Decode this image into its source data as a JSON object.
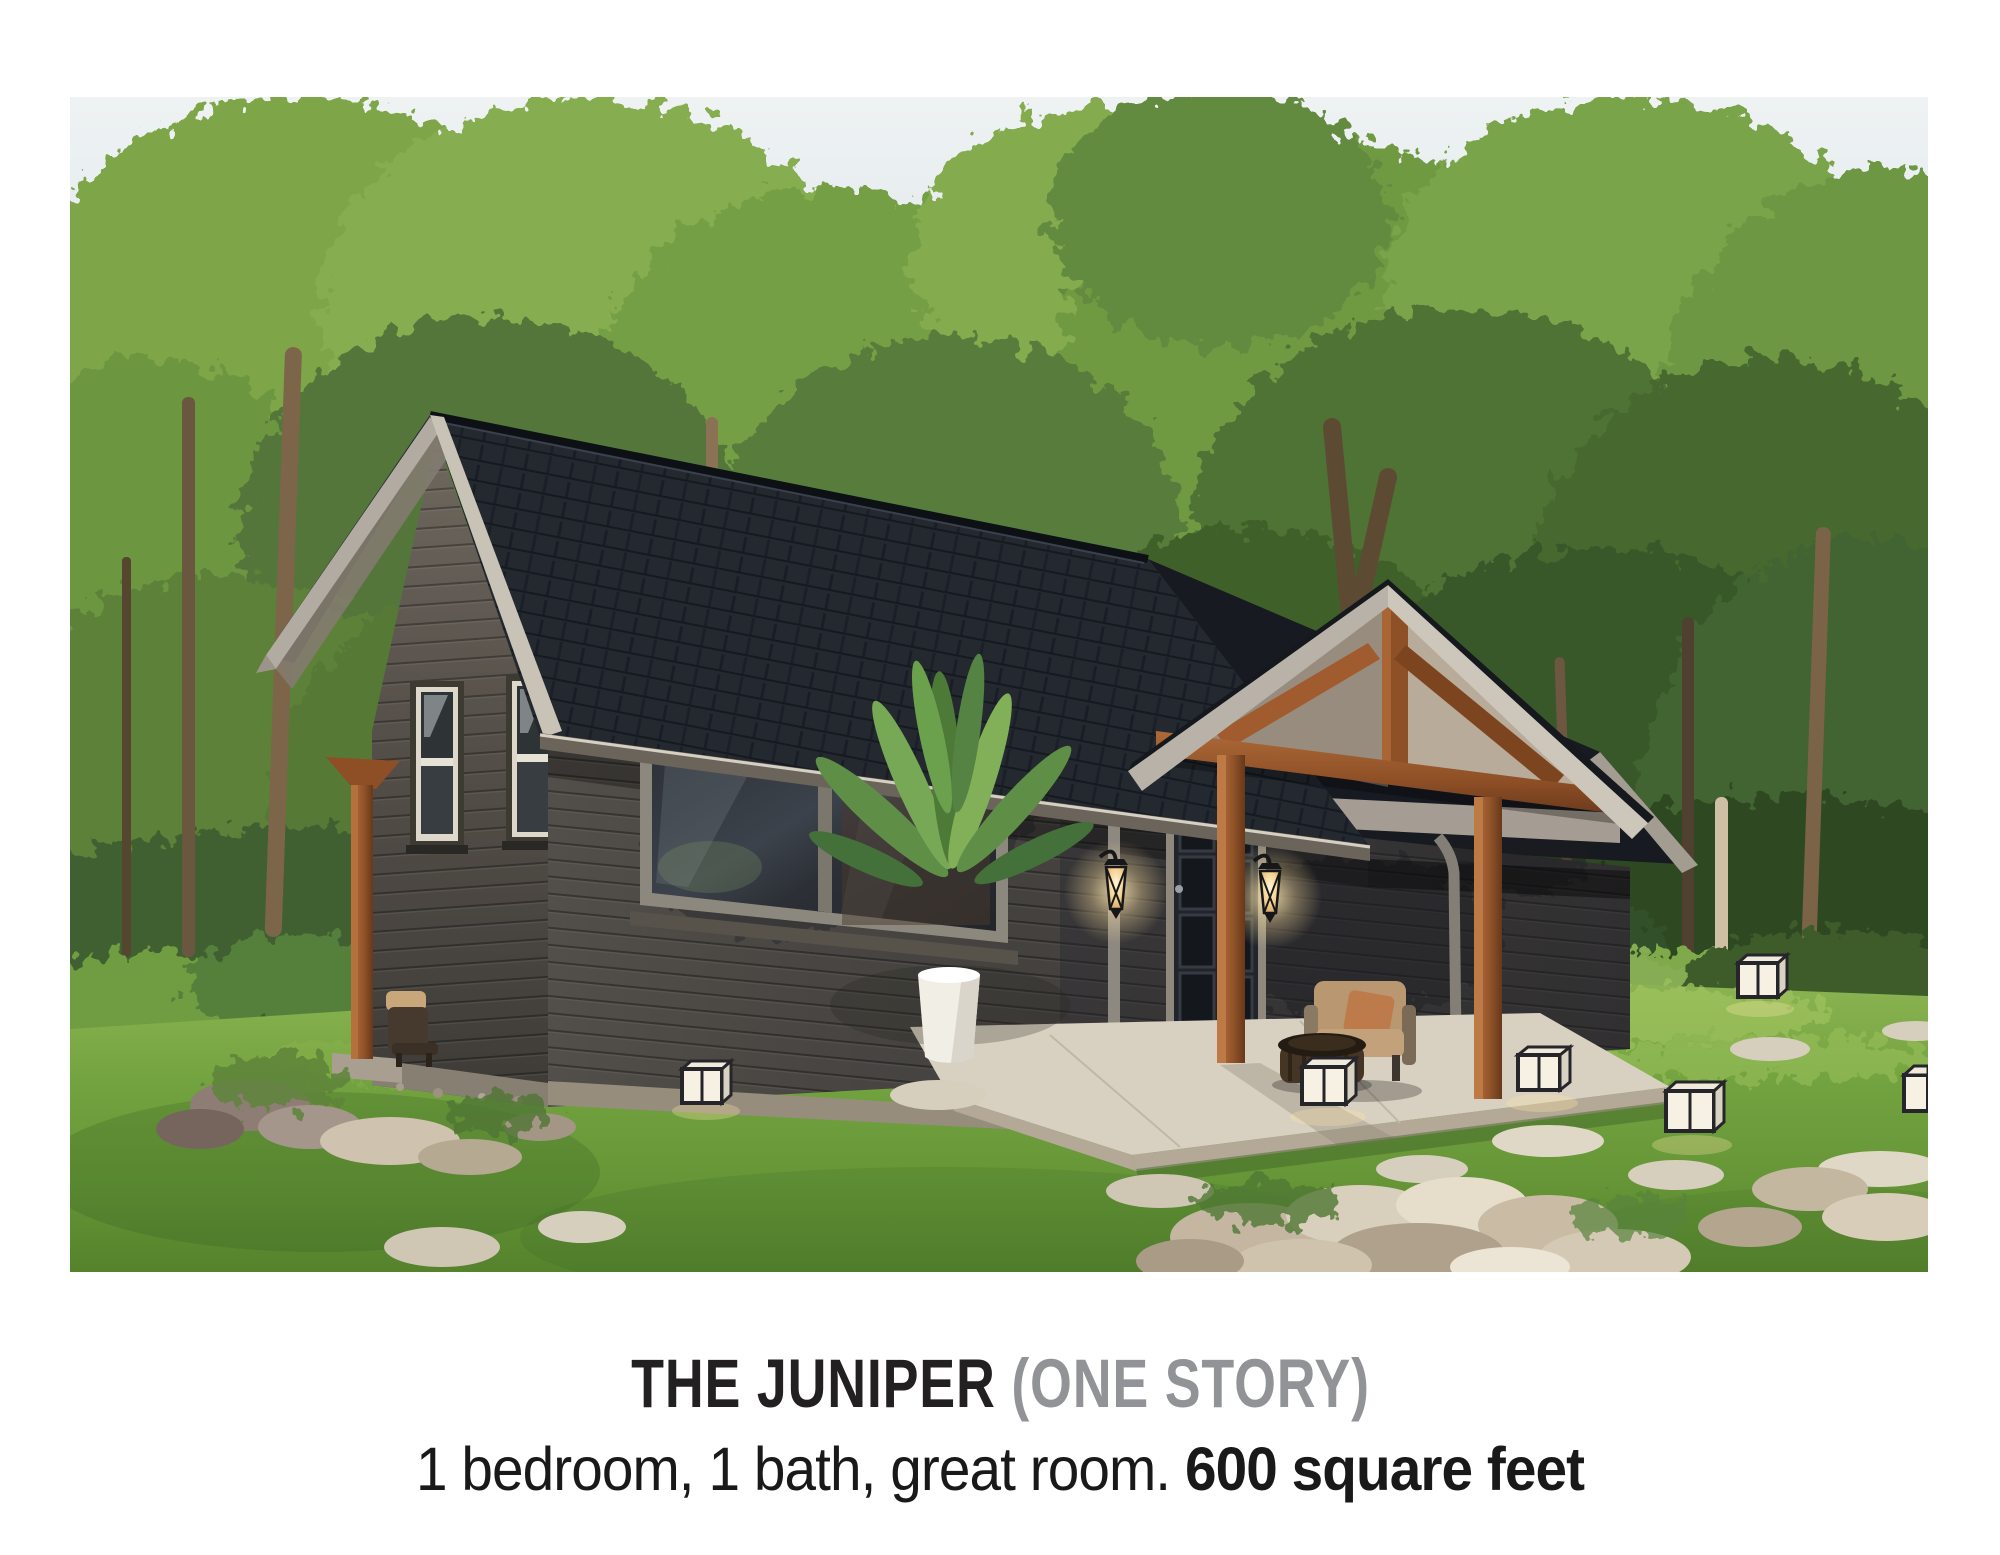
{
  "caption": {
    "title": "THE JUNIPER",
    "title_qualifier": " (ONE STORY)",
    "subtitle_regular": "1 bedroom, 1 bath, great room. ",
    "subtitle_bold": "600 square feet",
    "title_color": "#232021",
    "qualifier_color": "#919396",
    "subtitle_color": "#191919"
  },
  "photo": {
    "subject": "one-story-cabin-exterior-rendering-in-forest-clearing",
    "palette": {
      "sky": "#d3dee4",
      "foliage_light": "#8db155",
      "foliage_mid": "#5f8a3c",
      "foliage_dark": "#33512a",
      "lawn": "#6f9e3c",
      "roof_shingle": "#1e2229",
      "siding": "#46423e",
      "timber_cedar": "#9a5a2c",
      "trim_fascia": "#bdb6ac",
      "stone_rock": "#d2c8b4",
      "lantern_glow": "#f5d79a"
    }
  }
}
